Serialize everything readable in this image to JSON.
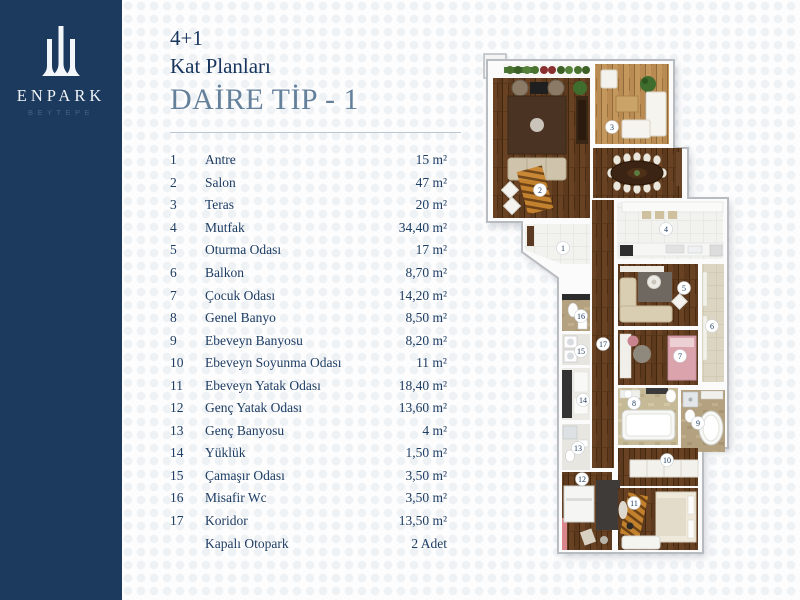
{
  "brand": {
    "name": "ENPARK",
    "subtitle": "BEYTEPE"
  },
  "header": {
    "category": "4+1",
    "subtitle": "Kat Planları",
    "title": "DAİRE TİP - 1"
  },
  "table": {
    "rows": [
      {
        "no": "1",
        "name": "Antre",
        "area": "15 m²"
      },
      {
        "no": "2",
        "name": "Salon",
        "area": "47 m²"
      },
      {
        "no": "3",
        "name": "Teras",
        "area": "20 m²"
      },
      {
        "no": "4",
        "name": "Mutfak",
        "area": "34,40 m²"
      },
      {
        "no": "5",
        "name": "Oturma Odası",
        "area": "17 m²"
      },
      {
        "no": "6",
        "name": "Balkon",
        "area": "8,70 m²"
      },
      {
        "no": "7",
        "name": "Çocuk Odası",
        "area": "14,20 m²"
      },
      {
        "no": "8",
        "name": "Genel Banyo",
        "area": "8,50 m²"
      },
      {
        "no": "9",
        "name": "Ebeveyn Banyosu",
        "area": "8,20 m²"
      },
      {
        "no": "10",
        "name": "Ebeveyn Soyunma Odası",
        "area": "11 m²"
      },
      {
        "no": "11",
        "name": "Ebeveyn Yatak Odası",
        "area": "18,40 m²"
      },
      {
        "no": "12",
        "name": "Genç Yatak Odası",
        "area": "13,60 m²"
      },
      {
        "no": "13",
        "name": "Genç Banyosu",
        "area": "4 m²"
      },
      {
        "no": "14",
        "name": "Yüklük",
        "area": "1,50 m²"
      },
      {
        "no": "15",
        "name": "Çamaşır Odası",
        "area": "3,50 m²"
      },
      {
        "no": "16",
        "name": "Misafir Wc",
        "area": "3,50 m²"
      },
      {
        "no": "17",
        "name": "Koridor",
        "area": "13,50 m²"
      },
      {
        "no": "",
        "name": "Kapalı Otopark",
        "area": "2 Adet"
      }
    ]
  },
  "colors": {
    "sidebar": "#1c3a5e",
    "heading": "#17355d",
    "title_accent": "#64809b",
    "body_text": "#1e3d63",
    "divider": "#b9c6d4",
    "wood_dark": "#5d3a1e",
    "wood_light": "#b98a51"
  }
}
